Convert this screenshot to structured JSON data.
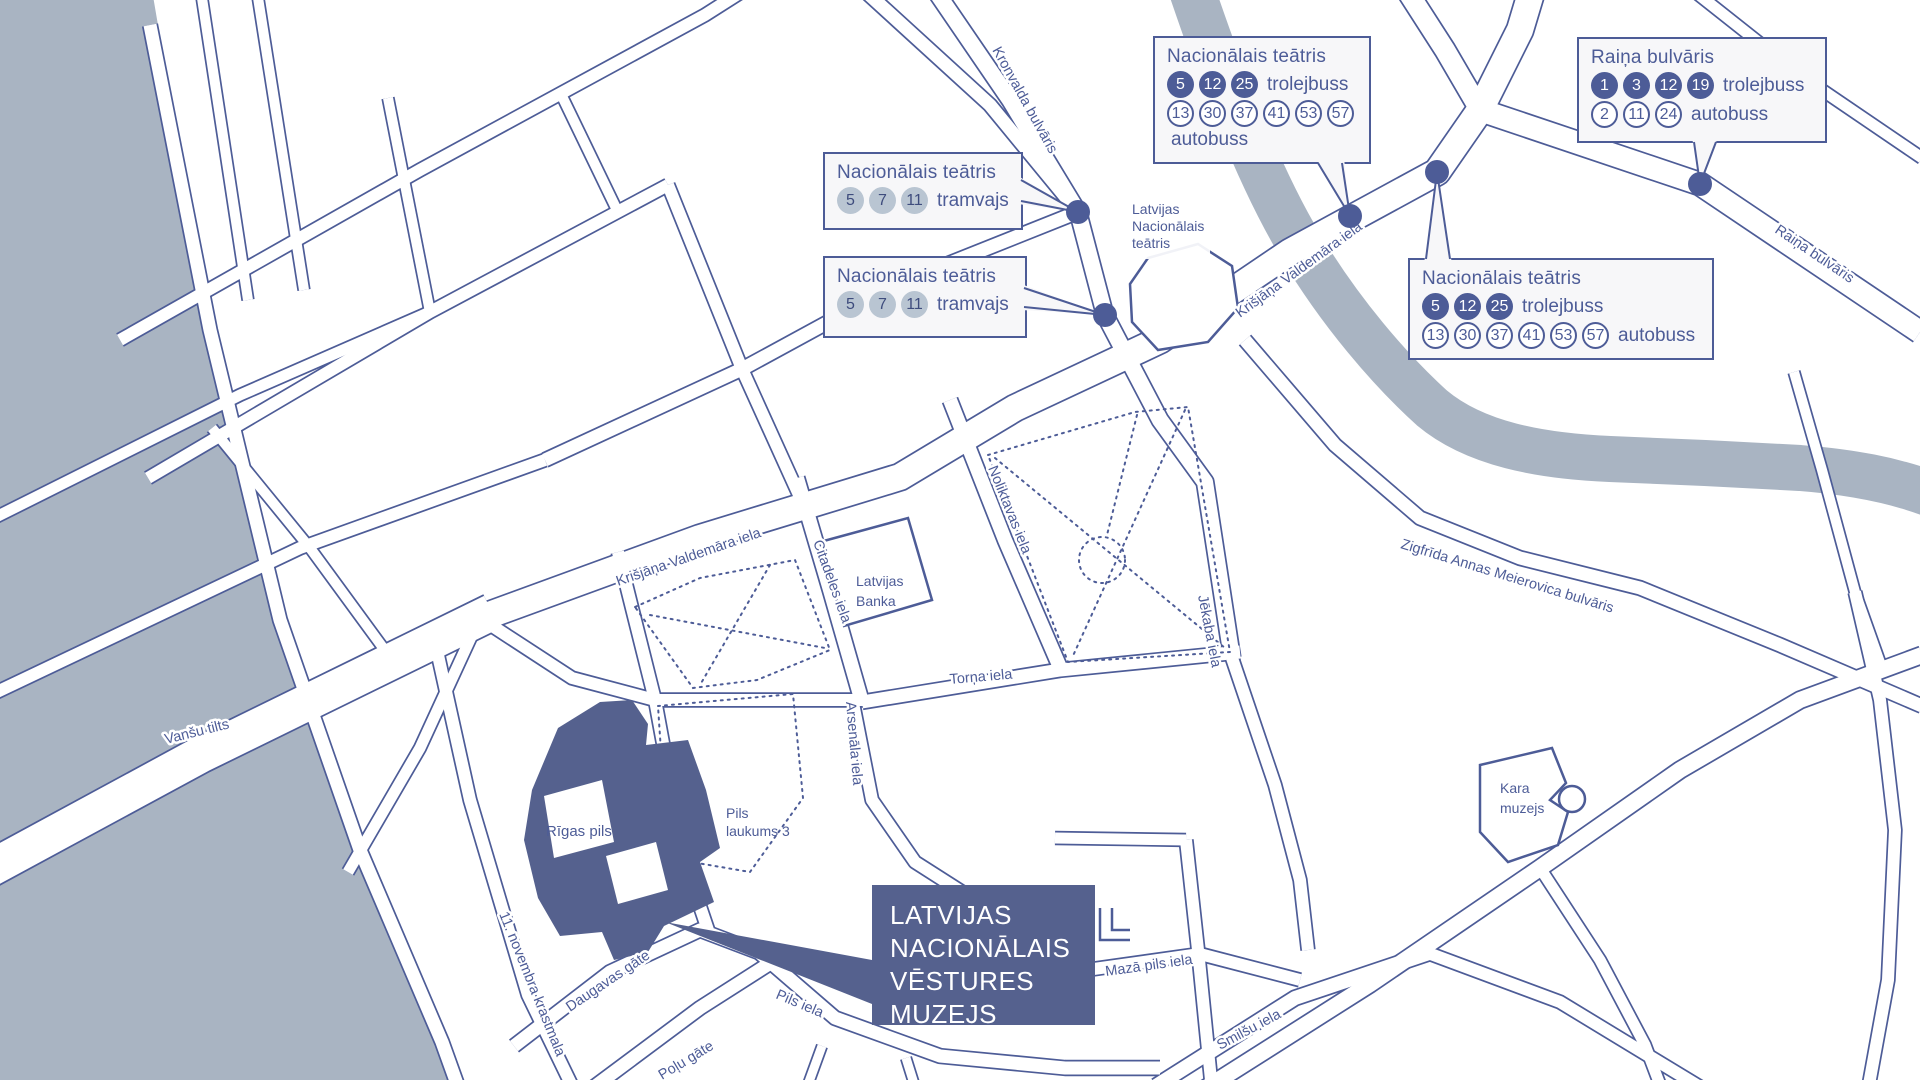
{
  "colors": {
    "line_blue": "#4d5c97",
    "dark_fill": "#55618e",
    "water": "#a9b4c2",
    "callout_bg": "#f7f7f9",
    "tram_badge": "#b9c5d2"
  },
  "callouts": {
    "tram_stop_1": {
      "title": "Nacionālais teātris",
      "rows": [
        {
          "style": "tram",
          "routes": [
            "5",
            "7",
            "11"
          ],
          "mode": "tramvajs"
        }
      ]
    },
    "tram_stop_2": {
      "title": "Nacionālais teātris",
      "rows": [
        {
          "style": "tram",
          "routes": [
            "5",
            "7",
            "11"
          ],
          "mode": "tramvajs"
        }
      ]
    },
    "teatris_stop_top": {
      "title": "Nacionālais teātris",
      "rows": [
        {
          "style": "filled",
          "routes": [
            "5",
            "12",
            "25"
          ],
          "mode": "trolejbuss"
        },
        {
          "style": "outline",
          "routes": [
            "13",
            "30",
            "37",
            "41",
            "53",
            "57"
          ],
          "mode": ""
        },
        {
          "style": "outline",
          "routes": [],
          "mode": "autobuss"
        }
      ]
    },
    "teatris_stop_right": {
      "title": "Nacionālais teātris",
      "rows": [
        {
          "style": "filled",
          "routes": [
            "5",
            "12",
            "25"
          ],
          "mode": "trolejbuss"
        },
        {
          "style": "outline",
          "routes": [
            "13",
            "30",
            "37",
            "41",
            "53",
            "57"
          ],
          "mode": "autobuss"
        }
      ]
    },
    "raina_stop": {
      "title": "Raiņa bulvāris",
      "rows": [
        {
          "style": "filled",
          "routes": [
            "1",
            "3",
            "12",
            "19"
          ],
          "mode": "trolejbuss"
        },
        {
          "style": "outline",
          "routes": [
            "2",
            "11",
            "24"
          ],
          "mode": "autobuss"
        }
      ]
    }
  },
  "museum_label": {
    "lines": [
      "LATVIJAS",
      "NACIONĀLAIS",
      "VĒSTURES",
      "MUZEJS"
    ]
  },
  "street_labels": {
    "kronvalda": "Kronvalda bulvāris",
    "valdemara_upper": "Krišjāņa Valdemāra iela",
    "valdemara_lower": "Krišjāņa Valdemāra iela",
    "raina": "Raiņa bulvāris",
    "vanshu": "Vanšu tilts",
    "krastmala": "11. novembra krastmala",
    "citadeles": "Citadeles iela",
    "noliktavas": "Noliktavas iela",
    "jekaba": "Jēkaba iela",
    "torna": "Torņa iela",
    "arsenala": "Arsenāla iela",
    "daugavas": "Daugavas gāte",
    "polu": "Poļu gāte",
    "pils": "Pils iela",
    "maza_pils": "Mazā pils iela",
    "smilsu": "Smilšu iela",
    "meierovica": "Zigfrīda Annas Meierovica bulvāris"
  },
  "place_labels": {
    "theatre_l1": "Latvijas",
    "theatre_l2": "Nacionālais",
    "theatre_l3": "teātris",
    "bank_l1": "Latvijas",
    "bank_l2": "Banka",
    "castle": "Rīgas pils",
    "laukums_l1": "Pils",
    "laukums_l2": "laukums 3",
    "kara_l1": "Kara",
    "kara_l2": "muzejs"
  }
}
